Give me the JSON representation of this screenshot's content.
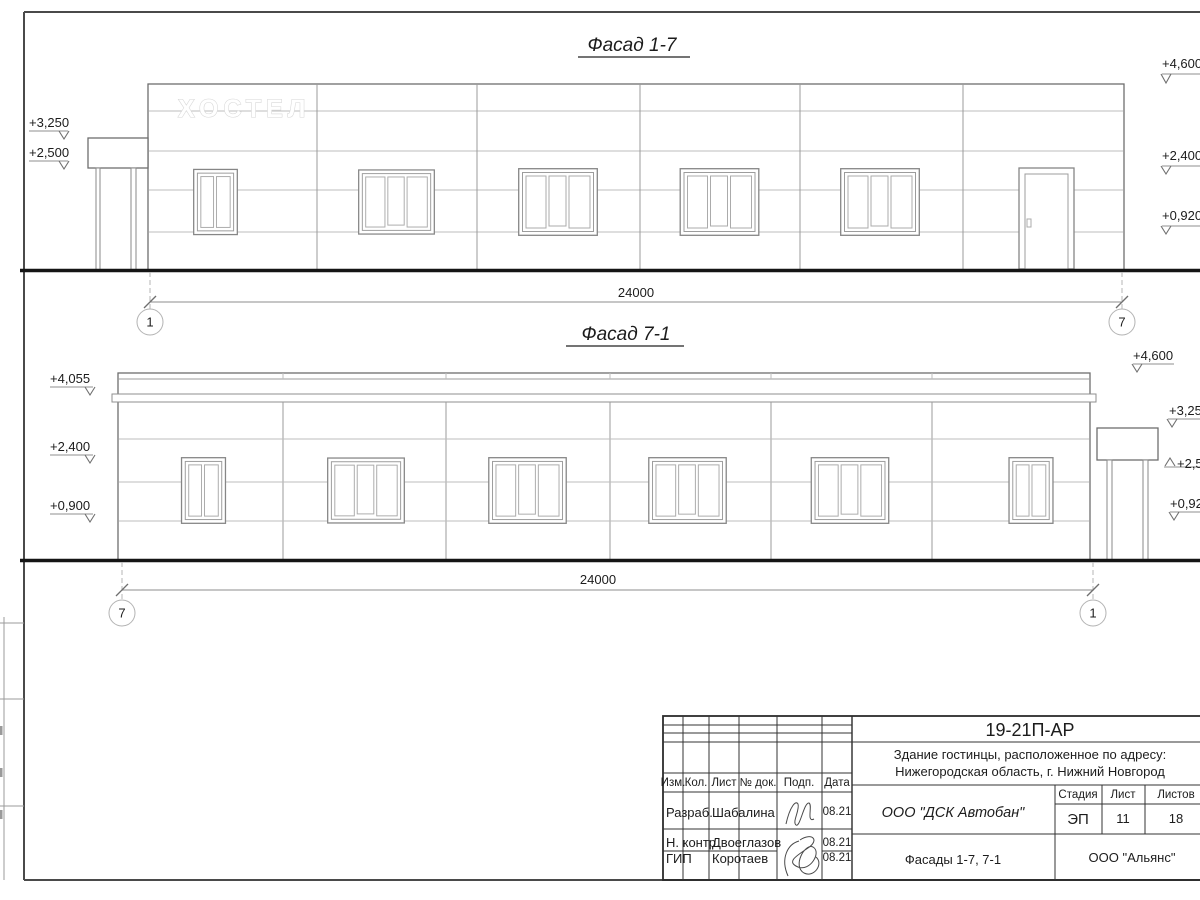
{
  "facade1": {
    "title": "Фасад 1-7",
    "sign": "ХОСТЕЛ",
    "dimension": "24000",
    "axis_left": "1",
    "axis_right": "7",
    "marks_left": {
      "m1": "+3,250",
      "m2": "+2,500"
    },
    "marks_right": {
      "m1": "+4,600",
      "m2": "+2,400",
      "m3": "+0,920"
    }
  },
  "facade2": {
    "title": "Фасад 7-1",
    "dimension": "24000",
    "axis_left": "7",
    "axis_right": "1",
    "marks_left": {
      "m1": "+4,055",
      "m2": "+2,400",
      "m3": "+0,900"
    },
    "marks_right": {
      "m1": "+4,600",
      "m2": "+3,250",
      "m3": "+2,500",
      "m4": "+0,920"
    }
  },
  "titleblock": {
    "doc_number": "19-21П-АР",
    "project_line1": "Здание гостинцы, расположенное по адресу:",
    "project_line2": "Нижегородская область, г. Нижний Новгород",
    "col_izm": "Изм.",
    "col_kol": "Кол.",
    "col_list": "Лист",
    "col_doc": "№ док.",
    "col_podp": "Подп.",
    "col_data": "Дата",
    "rows": [
      {
        "role": "Разраб.",
        "name": "Шабалина",
        "date": "08.21"
      },
      {
        "role": "Н. контр.",
        "name": "Двоеглазов",
        "date": "08.21"
      },
      {
        "role": "ГИП",
        "name": "Коротаев",
        "date": "08.21"
      }
    ],
    "company": "ООО \"ДСК Автобан\"",
    "stage_label": "Стадия",
    "sheet_label": "Лист",
    "sheets_label": "Листов",
    "stage": "ЭП",
    "sheet_number": "11",
    "sheets_total": "18",
    "drawing_title": "Фасады 1-7, 7-1",
    "design_firm": "ООО \"Альянс\""
  }
}
